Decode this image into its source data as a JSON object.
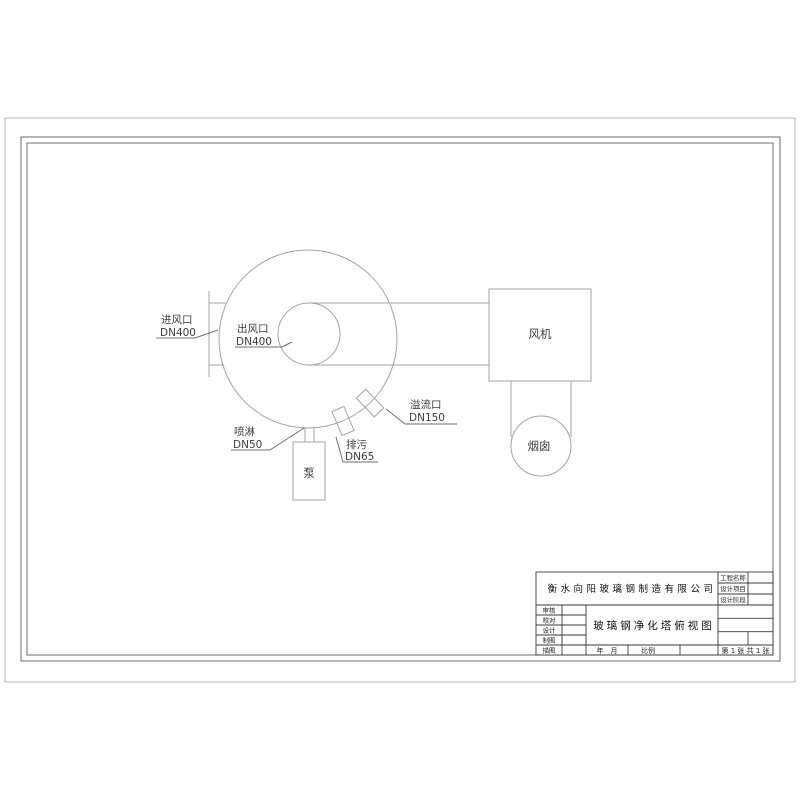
{
  "drawing": {
    "labels": {
      "inlet_name": "进风口",
      "inlet_size": "DN400",
      "outlet_name": "出风口",
      "outlet_size": "DN400",
      "spray_name": "喷淋",
      "spray_size": "DN50",
      "drain_name": "排污",
      "drain_size": "DN65",
      "overflow_name": "溢流口",
      "overflow_size": "DN150",
      "fan": "风机",
      "chimney": "烟囱",
      "pump": "泵"
    }
  },
  "title_block": {
    "company": "衡水向阳玻璃钢制造有限公司",
    "drawing_title": "玻璃钢净化塔俯视图",
    "project_fields": [
      "工程名称",
      "设计项目",
      "设计阶段"
    ],
    "role_fields": [
      "审核",
      "校对",
      "设计",
      "制图",
      "描图"
    ],
    "date_label": "年　月",
    "scale_label": "比例",
    "sheet_label": "第 1 张 共 1 张"
  },
  "colors": {
    "drawing_line": "#a3a3a3",
    "frame_line": "#6b6b6b",
    "title_block_line": "#3a3a3a",
    "text": "#3d3d3d"
  }
}
